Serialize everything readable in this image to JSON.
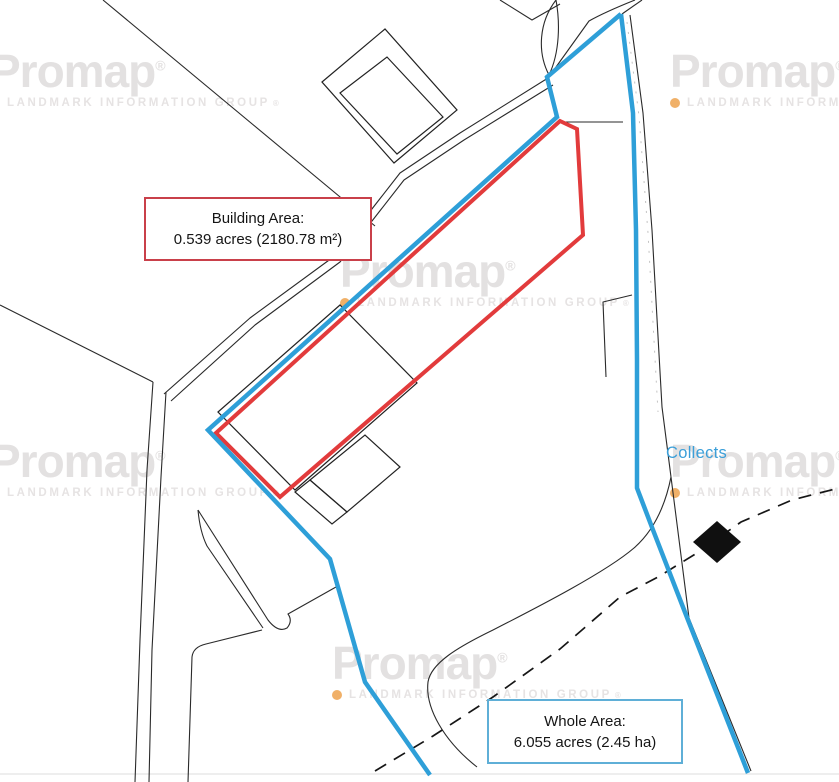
{
  "watermark": {
    "brand": "Promap",
    "brand_mark": "®",
    "subtitle": "LANDMARK INFORMATION GROUP",
    "subtitle_mark": "®"
  },
  "annotations": {
    "building_area": {
      "title": "Building Area:",
      "value": "0.539 acres (2180.78 m²)"
    },
    "whole_area": {
      "title": "Whole Area:",
      "value": "6.055 acres (2.45 ha)"
    },
    "collects_label": "Collects"
  },
  "colors": {
    "whole_area_outline": "#2E9FD8",
    "building_area_outline": "#E23B3C",
    "building_area_box_border": "#C9404A",
    "whole_area_box_border": "#5FAFD7",
    "map_line_black": "#2A2A2A",
    "footpath_dash_black": "#161616",
    "collects_text_blue": "#3B9FD9",
    "watermark_gray": "#E3E1E1",
    "watermark_dot_orange": "#F0B068"
  }
}
